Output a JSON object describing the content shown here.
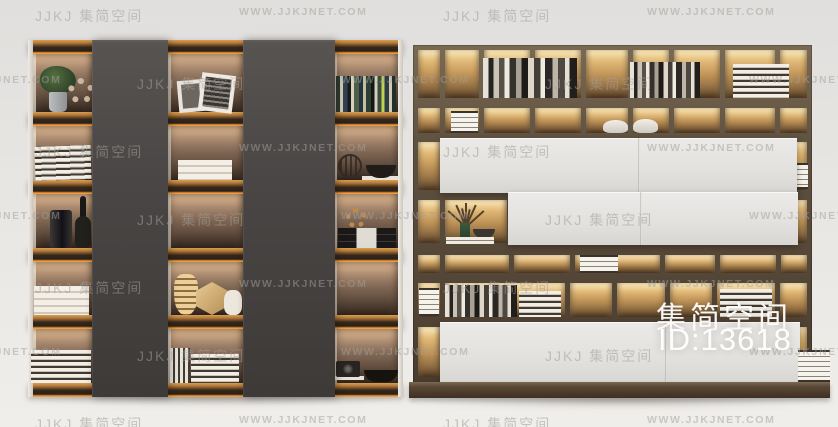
{
  "watermark": {
    "brand_text": "JJKJ 集简空间",
    "url_text": "WWW.JJKJNET.COM",
    "tile": {
      "rows": 7,
      "cols": 5,
      "col_width": 204,
      "row_height": 68,
      "start_x": 35,
      "start_y": 6,
      "odd_row_x_offset": -102
    }
  },
  "overlay_badge": {
    "site_name": "集简空间",
    "item_id": "ID:13618"
  },
  "scene": {
    "subject": "Two modern bookshelf display cabinet 3D furniture models with warm LED shelf lighting on a light studio background",
    "left_bookshelf": {
      "features": [
        "amber wood shelves with LED strip glow",
        "two dark gray full-height front panels",
        "white side boards",
        "backlit compartments"
      ],
      "decor_items": [
        "potted green plant",
        "beaded ring ornament",
        "leaning picture frames",
        "row of colorful books",
        "stacked magazines",
        "white book stacks",
        "black cylinder vase",
        "dark sculpted bottle vase",
        "wire sphere ornament",
        "black basket bowl",
        "gold striped vase",
        "gold hexagonal vase",
        "white jar",
        "vintage camera",
        "dark bowl"
      ]
    },
    "right_cabinet": {
      "features": [
        "dark walnut frame grid",
        "golden backlit compartments",
        "white cabinet door panels",
        "base plinth"
      ],
      "decor_items": [
        "rows of books",
        "white striped storage boxes",
        "white round jars",
        "dried flower arrangement in green vase",
        "black bowl on white books",
        "stacked striped magazines"
      ]
    }
  },
  "colors": {
    "background": "#e8e6e3",
    "left_shelf_wood": "#c98d44",
    "led_glow": "#ffab54",
    "panel_gray": "#4a4645",
    "cabinet_frame": "#5c4e3e",
    "compartment_glow": "#e7c27c",
    "door_white": "#e6e5e2",
    "base_brown": "#55432f",
    "watermark_gray": "#c2c0bc",
    "badge_white": "#ffffff"
  }
}
